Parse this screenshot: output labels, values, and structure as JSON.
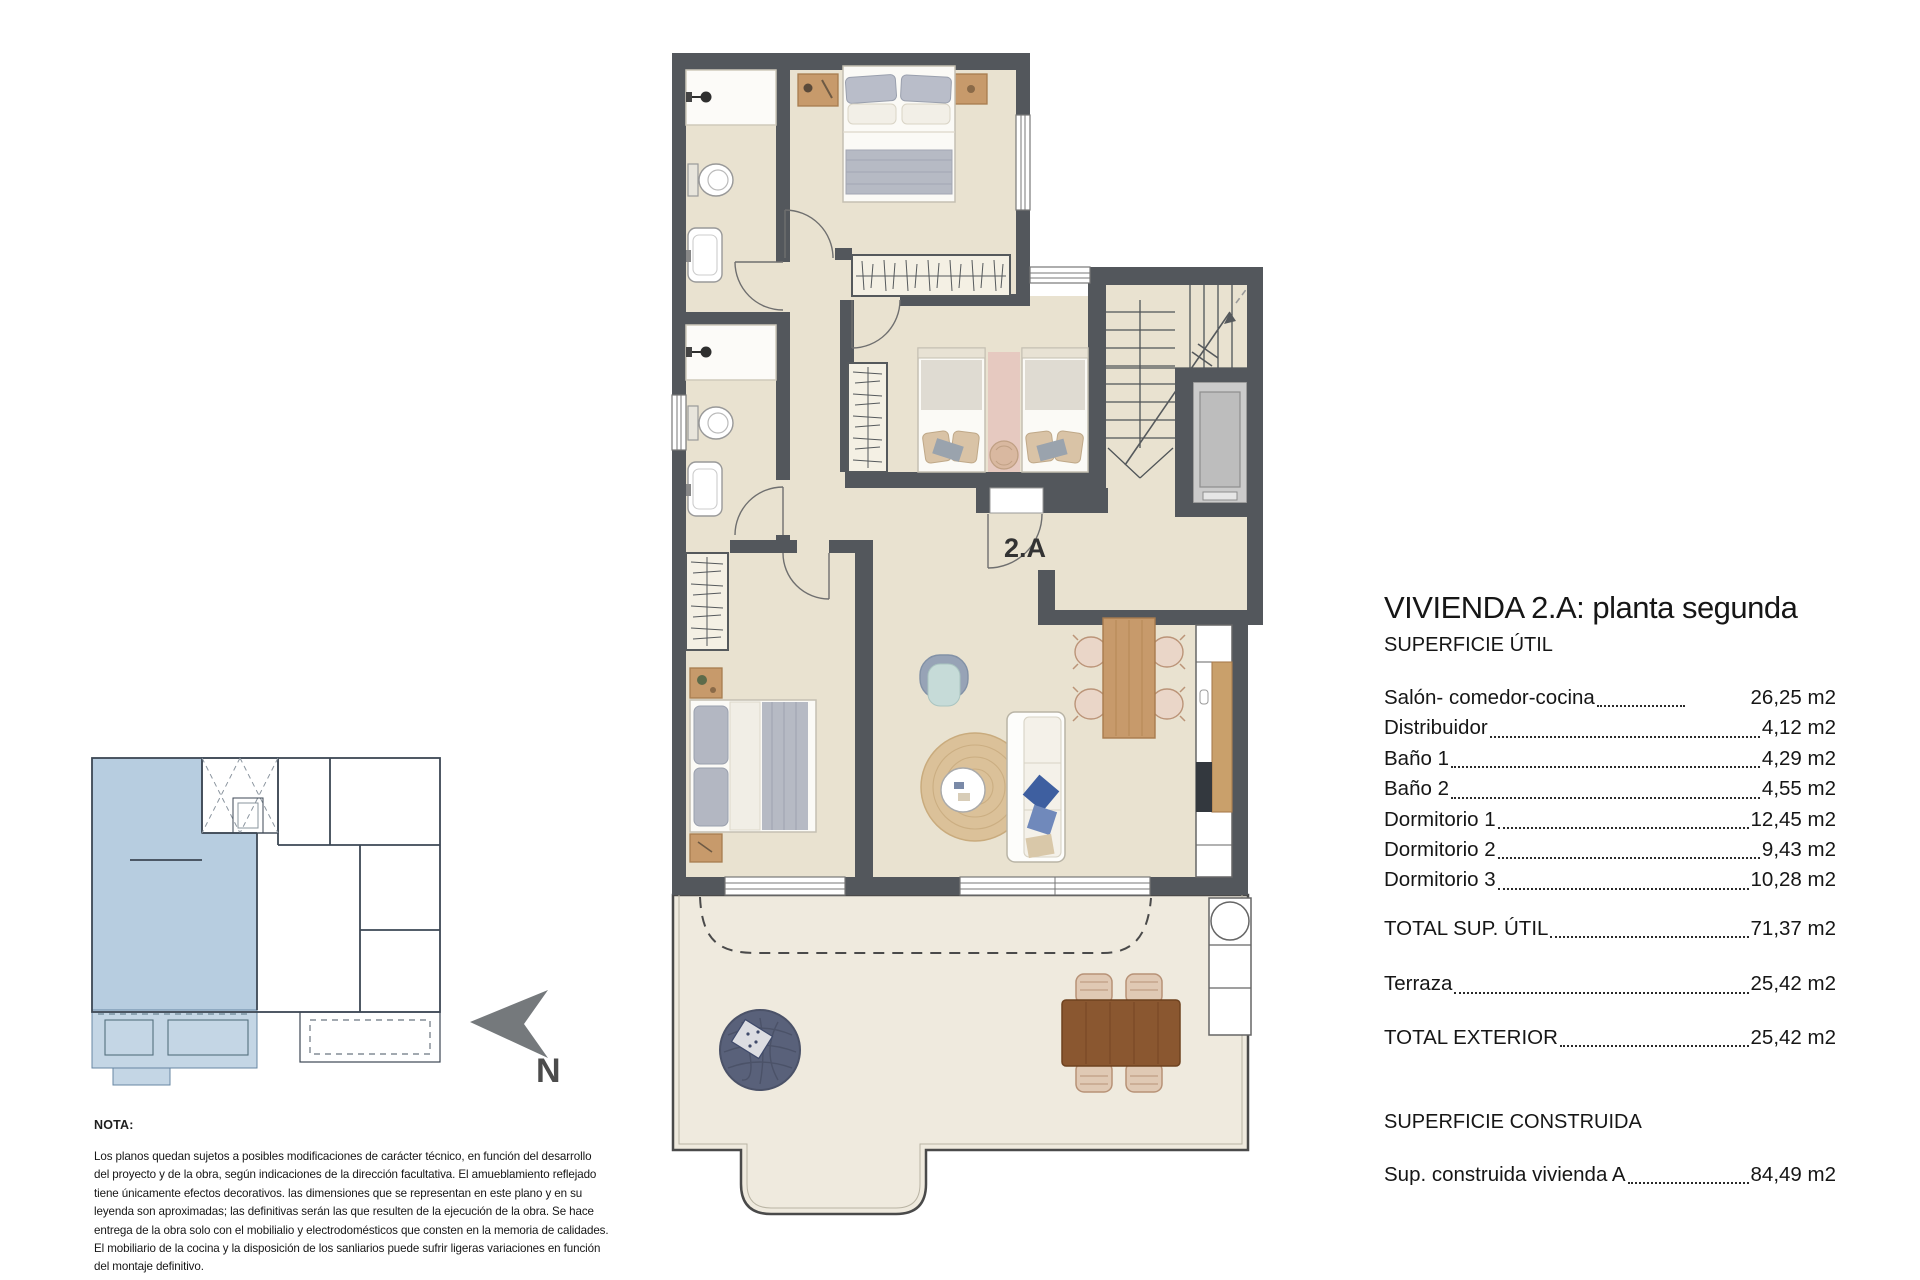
{
  "plan": {
    "unit_label": "2.A",
    "north_label": "N",
    "colors": {
      "wall": "#53575c",
      "floor": "#e9e2d0",
      "terrace_floor": "#efeade",
      "wood": "#c79a6b",
      "dark_wood": "#8a5730",
      "pouf": "#59617a",
      "rug": "#dbc199",
      "key_plan_blue": "#b7cde0",
      "blanket_gray": "#b6bac4",
      "pillow_blue": "#3e5fa0"
    }
  },
  "areas_panel": {
    "title": "VIVIENDA 2.A: planta segunda",
    "useful_header": "SUPERFICIE ÚTIL",
    "items": [
      {
        "label": "Salón- comedor-cocina",
        "value": "26,25 m2"
      },
      {
        "label": "Distribuidor",
        "value": "4,12 m2"
      },
      {
        "label": "Baño 1",
        "value": "4,29 m2"
      },
      {
        "label": "Baño 2",
        "value": "4,55 m2"
      },
      {
        "label": "Dormitorio 1",
        "value": "12,45 m2"
      },
      {
        "label": "Dormitorio 2",
        "value": "9,43 m2"
      },
      {
        "label": "Dormitorio 3",
        "value": "10,28 m2"
      }
    ],
    "total_util": {
      "label": "TOTAL SUP. ÚTIL",
      "value": "71,37 m2"
    },
    "terraza": {
      "label": "Terraza",
      "value": "25,42 m2"
    },
    "total_exterior": {
      "label": "TOTAL EXTERIOR",
      "value": "25,42 m2"
    },
    "built_header": "SUPERFICIE CONSTRUIDA",
    "built_row": {
      "label": "Sup. construida vivienda A",
      "value": "84,49 m2"
    }
  },
  "note": {
    "title": "NOTA:",
    "body": "Los planos quedan sujetos a posibles modificaciones de carácter técnico, en función del desarrollo\ndel proyecto y de la obra, según indicaciones de la dirección facultativa. El amueblamiento reflejado\ntiene únicamente efectos decorativos. las dimensiones que se representan en este plano y en su\nleyenda son aproximadas; las definitivas serán las que resulten de la ejecución de la obra. Se hace\nentrega de la obra solo con el mobilialio y electrodomésticos que consten en la memoria de calidades.\nEl mobiliario de la cocina y la disposición de los sanliarios puede sufrir ligeras variaciones en función\ndel montaje definitivo."
  }
}
